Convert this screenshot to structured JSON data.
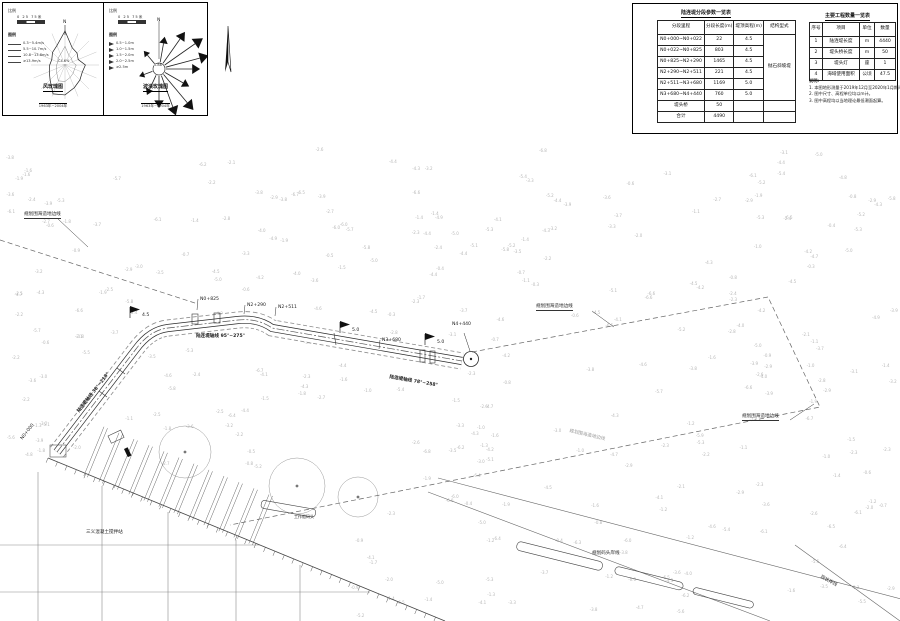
{
  "panels": {
    "wind": {
      "scale_label": "比例",
      "scale_text": "0 25 75米",
      "legend_label": "图例",
      "legend": [
        "0.3~5.4m/s",
        "5.5~10.7m/s",
        "10.8~13.8m/s",
        "≥13.9m/s"
      ],
      "north": "N",
      "center": "C4.6%",
      "caption": "风玫瑰图",
      "period": "1963年~2004年",
      "radii": [
        1.0,
        0.55,
        0.5,
        0.42,
        0.6,
        0.55,
        0.62,
        0.72,
        0.88,
        0.92,
        0.62,
        0.5,
        0.45,
        0.42,
        0.52,
        0.62
      ]
    },
    "wave": {
      "scale_label": "比例",
      "scale_text": "0 25 75米",
      "legend_label": "图例",
      "legend": [
        "0.5~1.0m",
        "1.0~1.5m",
        "1.5~2.0m",
        "2.0~2.5m",
        "≥2.5m"
      ],
      "north": "N",
      "center": "0.88",
      "caption": "波浪玫瑰图",
      "period": "1963年~2004年",
      "arrows": [
        {
          "a": 10,
          "l": 0.5
        },
        {
          "a": 35,
          "l": 0.8
        },
        {
          "a": 55,
          "l": 1.0
        },
        {
          "a": 75,
          "l": 0.95
        },
        {
          "a": 90,
          "l": 0.7
        },
        {
          "a": 120,
          "l": 0.55
        },
        {
          "a": 140,
          "l": 1.0
        },
        {
          "a": 160,
          "l": 0.9
        },
        {
          "a": 180,
          "l": 0.65
        },
        {
          "a": 205,
          "l": 0.4
        },
        {
          "a": 250,
          "l": 0.22
        },
        {
          "a": 320,
          "l": 0.28
        }
      ]
    }
  },
  "tables": {
    "segment": {
      "title": "陆连堤分段参数一览表",
      "headers": [
        "分段里程",
        "分段长度(m)",
        "堤顶高程(m)",
        "结构型式"
      ],
      "rows": [
        [
          "N0+000~N0+022",
          "22",
          "4.5"
        ],
        [
          "N0+022~N0+825",
          "803",
          "4.5"
        ],
        [
          "N0+825~N2+290",
          "1465",
          "4.5"
        ],
        [
          "N2+290~N2+511",
          "221",
          "4.5"
        ],
        [
          "N2+511~N3+680",
          "1169",
          "5.0"
        ],
        [
          "N3+680~N4+440",
          "760",
          "5.0"
        ]
      ],
      "structure_type": "抛石斜坡堤",
      "extra_rows": [
        [
          "堤头桥",
          "50"
        ],
        [
          "合计",
          "4490"
        ]
      ]
    },
    "quantity": {
      "title": "主要工程数量一览表",
      "headers": [
        "序号",
        "项目",
        "单位",
        "数量"
      ],
      "rows": [
        [
          "1",
          "陆连堤长度",
          "m",
          "4440"
        ],
        [
          "2",
          "堤头桥长度",
          "m",
          "50"
        ],
        [
          "3",
          "堤头灯",
          "座",
          "1"
        ],
        [
          "4",
          "海域使用面积",
          "公顷",
          "47.5"
        ]
      ]
    }
  },
  "notes": {
    "title": "说明:",
    "items": [
      "1. 本图地形测量于2019年12月至2020年1月期间测绘。",
      "2. 图中尺寸、高程单位均以m计。",
      "3. 图中高程均以当地理论最低潮面起算。"
    ]
  },
  "plan": {
    "axis1": "陆连堤轴线 38°~218°",
    "axis2": "陆连堤轴线 95°~275°",
    "axis3": "陆连堤轴线 78°~258°",
    "ch0": "N0+000",
    "ch1": "N0+825",
    "ch2": "N2+290",
    "ch3": "N2+511",
    "ch4": "N3+680",
    "ch5": "N4+440",
    "flag1": "4.5",
    "flag2": "5.0",
    "flag3": "5.0",
    "boundary": "规划围海造地边线",
    "mixing_plant": "三义混凝土搅拌站",
    "work_wharf": "工作船码头",
    "planned_wharf": "规划码头岸线",
    "coastline": "现状岸线"
  },
  "soundings": {
    "seed": 20240601,
    "count": 330,
    "min": -6.8,
    "max": -0.3
  }
}
